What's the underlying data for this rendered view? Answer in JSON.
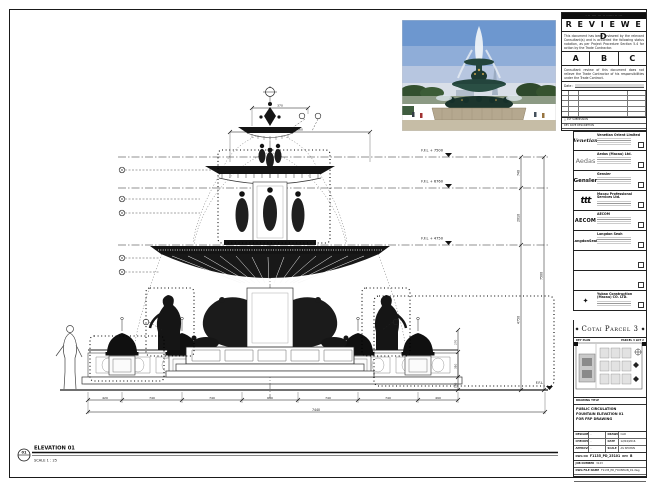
{
  "stamp": {
    "header_bar": "· ·· ···· ··· ·· ······ ·· ···",
    "title": "R E V I E W E D",
    "para1": "This document has been reviewed by the relevant Consultant(s) and is accorded the following status notation, as per Project Procedure Section 5.4 for action by the Trade Contractor.",
    "grades": [
      "A",
      "B",
      "C"
    ],
    "para2": "Consultant review of this document does not relieve the Trade Contractor of his responsibilities under the Trade Contract.",
    "date_label": "Date :",
    "footer_row1": "△   1ST SUBMISSION",
    "footer_row2": "REV   DATE   DESCRIPTION"
  },
  "consultants": [
    {
      "logo": "Venetian",
      "name": "Venetian Orient Limited"
    },
    {
      "logo": "Aedas",
      "name": "Aedas (Macau) Ltd."
    },
    {
      "logo": "Gensler",
      "name": "Gensler"
    },
    {
      "logo": "ttt",
      "name": "Macau Professional Services Ltd."
    },
    {
      "logo": "AECOM",
      "name": "AECOM"
    },
    {
      "logo": "LangdonSeah",
      "name": "Langdon Seah"
    },
    {
      "logo": "",
      "name": ""
    },
    {
      "logo": "",
      "name": ""
    },
    {
      "logo": "✦",
      "name": "Yubao Construction (Macau) CO. LTD."
    }
  ],
  "project": {
    "title": "Cotai Parcel 3",
    "ornament": "◆",
    "key_plan_left": "KEY PLAN",
    "key_plan_right": "PARCEL 3 LOT 2"
  },
  "title_block": {
    "label": "DRAWING TITLE",
    "line1": "PUBLIC CIRCULATION",
    "line2": "FOUNTAIN ELEVATION 01",
    "line3": "FOR FRP DRAWING",
    "designed_label": "DESIGNED",
    "designed": "-",
    "drawn_label": "DRAWN",
    "drawn": "CAD",
    "checked_label": "CHECKED",
    "checked": "-",
    "date_label": "DATE",
    "date": "12/04/2016",
    "approved_label": "APPROVED",
    "approved": "-",
    "scale_label": "SCALE",
    "scale": "AS SHOWN",
    "dwg_label": "DWG NO",
    "dwg_no": "F1135_PD_25101",
    "rev_label": "REV",
    "rev": "B",
    "job_label": "JOB NUMBER",
    "job": "3123",
    "file_label": "DWG FILE NAME",
    "file": "F1135_PD_FOUNTAIN_01.dwg",
    "ref_label": "REFERENCE DWG FILE NAME",
    "ref": ""
  },
  "drawing": {
    "label": "ELEVATION 01",
    "marker": "01",
    "scale": "SCALE  1 : 25",
    "levels": [
      "F.F.L + 7500",
      "F.F.L + 6760",
      "F.F.L + 4750",
      "F.F.L"
    ],
    "vdims": [
      "740",
      "2010",
      "4750",
      "7500"
    ],
    "rdims": [
      "270",
      "310",
      "160"
    ],
    "bdims": [
      "420",
      "740",
      "740",
      "690",
      "740",
      "740",
      "490"
    ],
    "overall": "7440",
    "top_dims": [
      "370",
      "660"
    ]
  }
}
